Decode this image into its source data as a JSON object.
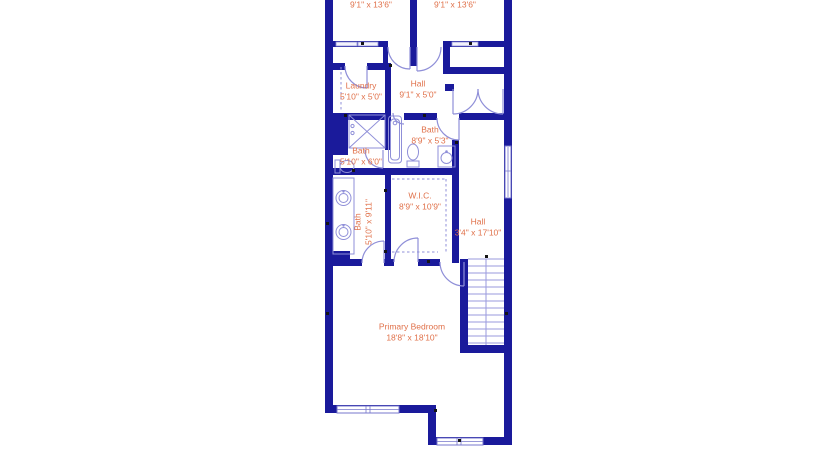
{
  "title": "Floor plan",
  "colors": {
    "wall": "#1a1a9b",
    "fixture": "#8f8fd8",
    "label": "#e0714a",
    "background": "#ffffff"
  },
  "rooms": {
    "bedroom_left": {
      "dims": "9'1\" x 13'6\""
    },
    "bedroom_right": {
      "dims": "9'1\" x 13'6\""
    },
    "laundry": {
      "name": "Laundry",
      "dims": "5'10\" x 5'0\""
    },
    "hall_upper": {
      "name": "Hall",
      "dims": "9'1\" x 5'0\""
    },
    "bath_hall": {
      "name": "Bath",
      "dims": "8'9\" x 5'3\""
    },
    "bath_small": {
      "name": "Bath",
      "dims": "5'10\" x 6'0\""
    },
    "bath_primary": {
      "name": "Bath",
      "dims": "5'10\" x 9'11\""
    },
    "wic": {
      "name": "W.I.C.",
      "dims": "8'9\" x 10'9\""
    },
    "hall_lower": {
      "name": "Hall",
      "dims": "3'4\" x 17'10\""
    },
    "primary_bedroom": {
      "name": "Primary Bedroom",
      "dims": "18'8\" x 18'10\""
    }
  },
  "fixtures": [
    "bathtub",
    "toilet",
    "toilet",
    "sink-vanity",
    "double-vanity",
    "shower",
    "staircase",
    "closet-shelves",
    "bifold-door",
    "windows",
    "door-swings"
  ]
}
